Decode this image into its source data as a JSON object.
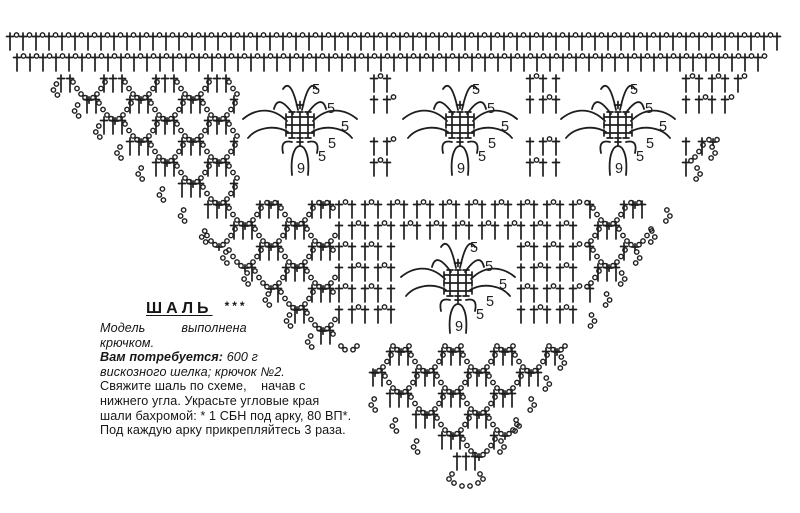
{
  "page": {
    "paper_color": "#ffffff",
    "ink_color": "#1e1e1e"
  },
  "text_block": {
    "title": "ШАЛЬ",
    "stars": "***",
    "line1": "Модель          выполнена",
    "line2": "крючком.",
    "needs_label": "Вам потребуется:",
    "needs_value": " 600 г",
    "line4": "вискозного шелка; крючок №2.",
    "line5": "Свяжите шаль по схеме,    начав с",
    "line6": "нижнего угла. Украсьте угловые края",
    "line7": "шали бахромой: * 1 СБН под арку, 80 ВП*.",
    "line8": "Под каждую арку прикрепляйтесь 3 раза."
  },
  "diagram": {
    "petal_label": "5",
    "arch_label": "9",
    "motifs": [
      {
        "cx": 300,
        "cy": 125
      },
      {
        "cx": 460,
        "cy": 125
      },
      {
        "cx": 618,
        "cy": 125
      },
      {
        "cx": 458,
        "cy": 283
      }
    ]
  }
}
